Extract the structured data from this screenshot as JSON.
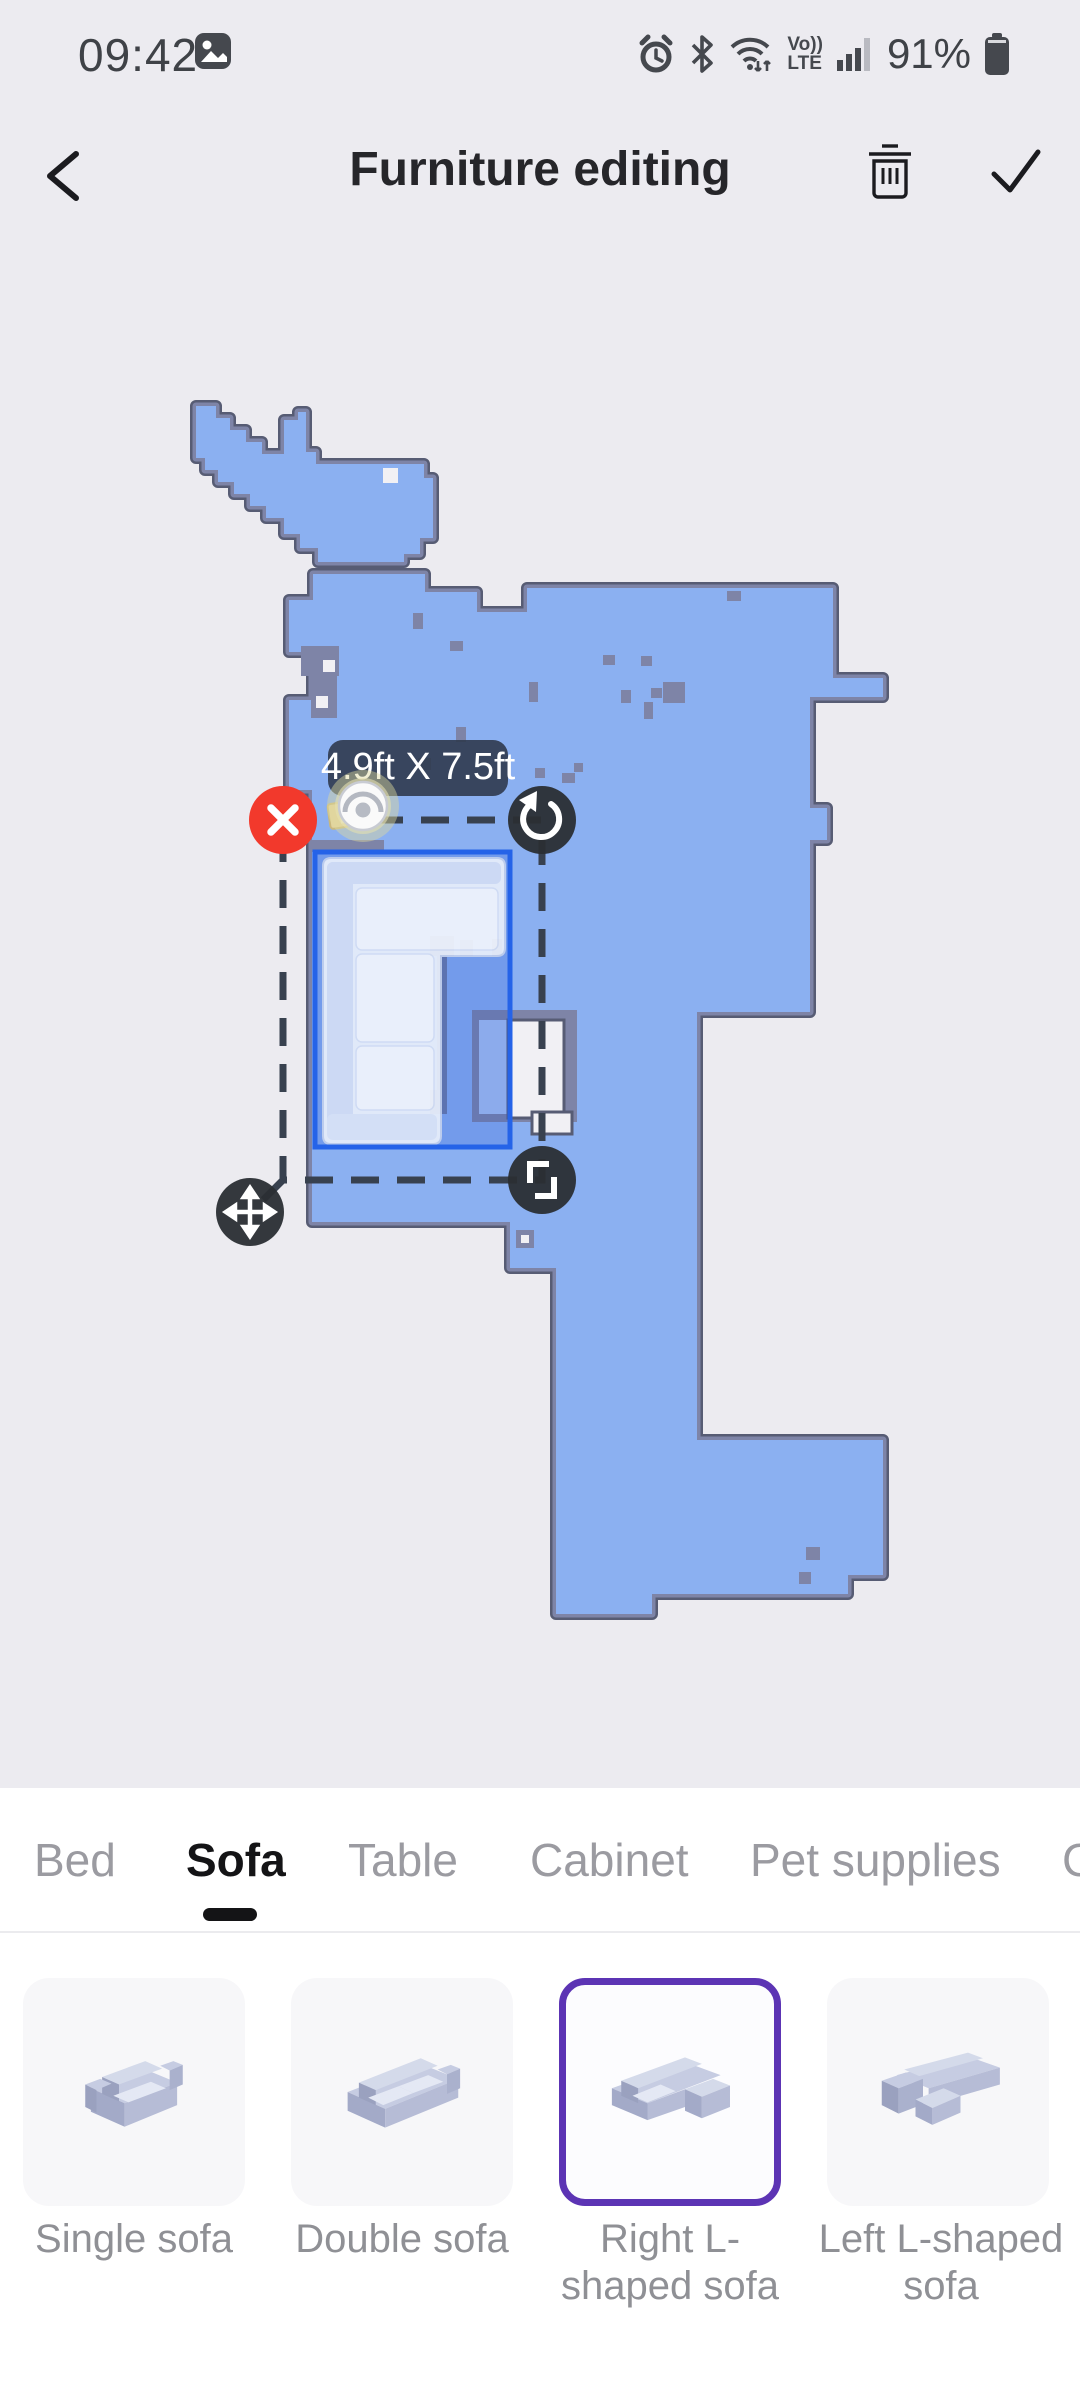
{
  "status_bar": {
    "time": "09:42",
    "battery_percent": "91%",
    "volte_top": "Vo))",
    "volte_bottom": "LTE"
  },
  "header": {
    "title": "Furniture editing"
  },
  "map": {
    "furniture_size_label": "4.9ft X 7.5ft",
    "selected_furniture": "Right L-shaped sofa"
  },
  "tabs": {
    "items": [
      {
        "label": "Bed",
        "active": false
      },
      {
        "label": "Sofa",
        "active": true
      },
      {
        "label": "Table",
        "active": false
      },
      {
        "label": "Cabinet",
        "active": false
      },
      {
        "label": "Pet supplies",
        "active": false
      },
      {
        "label": "C",
        "active": false
      }
    ]
  },
  "furniture_items": [
    {
      "label": "Single sofa",
      "selected": false
    },
    {
      "label": "Double sofa",
      "selected": false
    },
    {
      "label": "Right L-shaped sofa",
      "selected": true
    },
    {
      "label": "Left L-shaped sofa",
      "selected": false
    }
  ],
  "colors": {
    "background": "#ecebf0",
    "map_floor": "#8bb0f1",
    "map_wall": "#7e84a7",
    "selection_border": "#2563e8",
    "delete_red": "#f2392c",
    "handle_dark": "#2e3237",
    "accent_purple": "#5c34b4",
    "active_tab": "#141416",
    "inactive_tab": "#9b9ba1"
  }
}
